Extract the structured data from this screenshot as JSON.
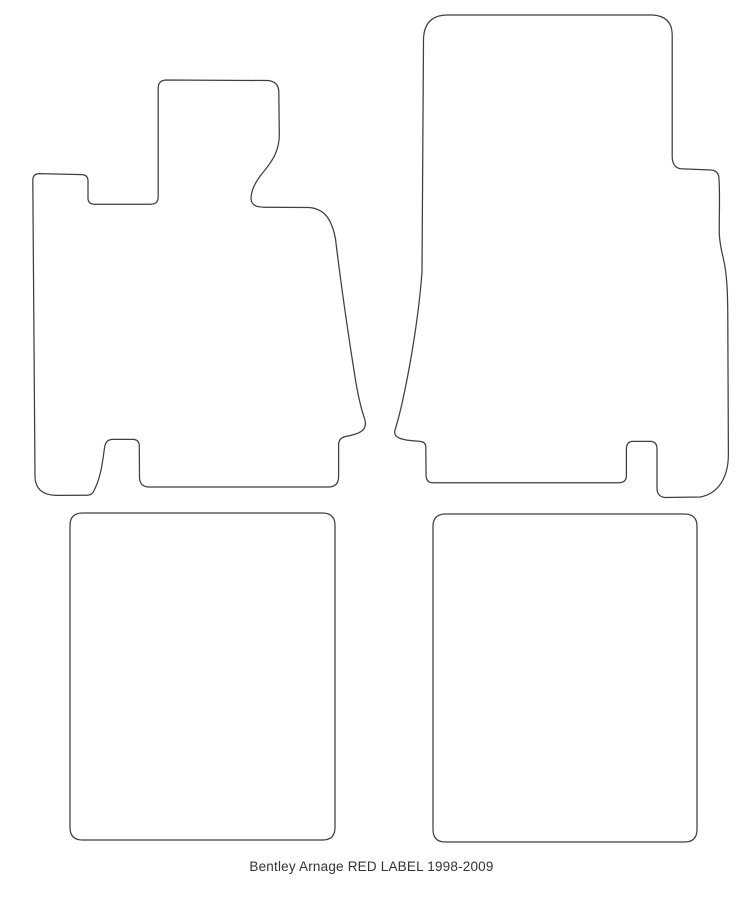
{
  "page": {
    "background": "#ffffff"
  },
  "caption": {
    "text": "Bentley Arnage RED LABEL 1998-2009"
  },
  "drawing": {
    "stroke_color": "#3f3f3f",
    "fill_color": "#ffffff",
    "mats": [
      {
        "id": "front-left-mat",
        "path": "M 166 80 L 267 80.5 Q 278.5 81 278.8 92 L 279.3 133 C 279.8 151 272 161.5 263 172.5 C 255 182 251 190.5 251 199 Q 251.3 204 256.5 206.2 Q 260 207.2 265 207.3 L 309 207.5 Q 321.5 208.5 328 218 Q 333.3 226 335.5 239 C 339 268 347.5 330 355.5 380 C 358.3 397 361 408.5 364.7 419 Q 367.5 428.8 359 432.7 C 354.5 434.7 349.5 435.8 345 436.6 Q 338.6 438.2 338.6 445 L 338.6 476.5 Q 338.6 486.2 329.5 487 L 148.5 487 Q 140 486.5 139.5 478 L 139.3 446 Q 139.2 439.6 133 439.4 L 112.5 439.4 Q 106.3 439.6 104.8 446 C 102.8 459 101.5 477.5 93 492.5 Q 91 495.2 86.5 495.3 L 55.5 495.4 Q 36 494.6 35 477.5 L 32.8 180.5 Q 32.8 173.6 39.5 173.6 L 81.8 174.6 Q 88 174.9 88 181 L 88 198 Q 88 204.1 94.5 204.2 L 151 204.2 Q 158.2 204.1 158.2 197 L 158.2 88 Q 158.3 80.4 166 80 Z"
      },
      {
        "id": "front-right-mat",
        "path": "M 446 15 L 652.5 15 Q 671.5 16 672.2 34 L 672.2 157.5 Q 672.8 167.5 680.5 168.7 L 711 170 Q 718.2 170.6 718.9 177.5 C 720.2 196 719 220 719.3 233 C 719.5 245.5 722.3 252.5 724.7 265 C 727.2 279.5 727.7 295 727.8 320 L 728.4 454 C 728.4 478 718 493.8 700 497 L 664.5 497.5 Q 657.3 496.2 657 489 L 657 448.5 Q 656.8 441.6 650.3 441.4 L 632.8 441.4 Q 626.6 441.6 626.4 448.5 L 626.4 475.8 Q 626.3 482.5 619.5 482.7 L 433 482.8 Q 426.4 482.6 426.1 476 L 425.8 446.5 Q 425.5 441.9 420 441.4 C 412 440.7 401.3 440.2 396.8 436.6 Q 393.7 434 395.2 429.5 C 400.3 413 406.5 384 412 352 C 416.5 325 420.3 295 422 272 L 423.5 40 Q 423.8 16 446 15 Z"
      },
      {
        "id": "rear-left-mat",
        "path": "M 82.5 513 L 322.5 513 Q 335 513 335 525.5 L 335 827.5 Q 335 840 322.5 840 L 82.5 840 Q 70 840 70 827.5 L 70 525.5 Q 70 513 82.5 513 Z"
      },
      {
        "id": "rear-right-mat",
        "path": "M 445.5 514 L 684.5 514 Q 697 514 697 526.5 L 697 829.5 Q 697 842 684.5 842 L 445.5 842 Q 433 842 433 829.5 L 433 526.5 Q 433 514 445.5 514 Z"
      }
    ]
  }
}
